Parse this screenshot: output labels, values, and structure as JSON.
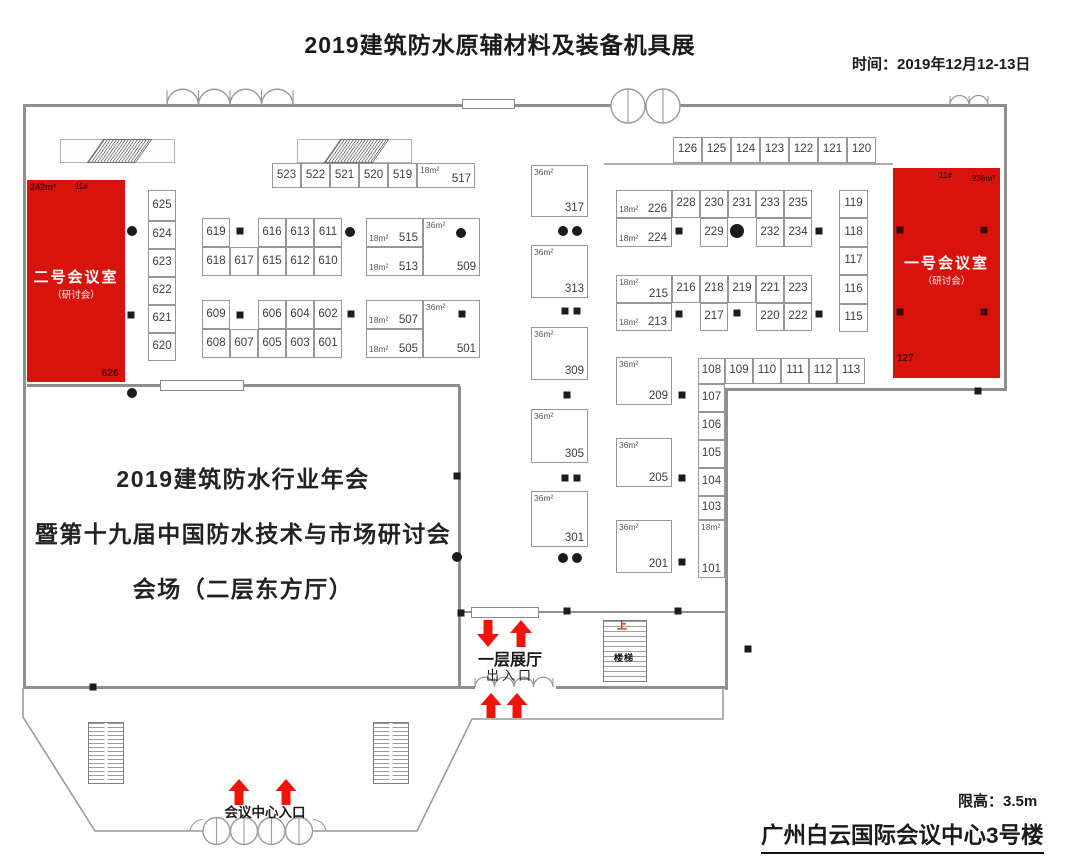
{
  "header": {
    "title": "2019建筑防水原辅材料及装备机具展",
    "time_label": "时间：2019年12月12-13日"
  },
  "footer": {
    "height_limit": "限高：3.5m",
    "building": "广州白云国际会议中心3号楼"
  },
  "hall_text": {
    "line1": "2019建筑防水行业年会",
    "line2": "暨第十九届中国防水技术与市场研讨会",
    "line3": "会场（二层东方厅）"
  },
  "rooms": {
    "room2": {
      "area": "242m²",
      "lot": "11#",
      "name": "二号会议室",
      "sub": "（研讨会）",
      "booth": "626"
    },
    "room1": {
      "lot": "11#",
      "area": "236m²",
      "name": "一号会议室",
      "sub": "（研讨会）",
      "booth": "127"
    }
  },
  "labels": {
    "stairs": "楼梯",
    "up": "上",
    "hall_1f": "一层展厅",
    "exit": "出入口",
    "center_entrance": "会议中心入口"
  },
  "colors": {
    "room_red": "#d8130d",
    "arrow_red": "#ee1409",
    "wall_gray": "#8f8f8f",
    "booth_border": "#979797"
  },
  "booths": [
    {
      "x": 272,
      "y": 163,
      "w": 29,
      "h": 25,
      "n": "523"
    },
    {
      "x": 301,
      "y": 163,
      "w": 29,
      "h": 25,
      "n": "522"
    },
    {
      "x": 330,
      "y": 163,
      "w": 29,
      "h": 25,
      "n": "521"
    },
    {
      "x": 359,
      "y": 163,
      "w": 29,
      "h": 25,
      "n": "520"
    },
    {
      "x": 388,
      "y": 163,
      "w": 29,
      "h": 25,
      "n": "519"
    },
    {
      "x": 417,
      "y": 163,
      "w": 58,
      "h": 25,
      "n": "517",
      "a": "18m²",
      "s": "corner"
    },
    {
      "x": 148,
      "y": 190,
      "w": 28,
      "h": 31,
      "n": "625"
    },
    {
      "x": 148,
      "y": 221,
      "w": 28,
      "h": 28,
      "n": "624"
    },
    {
      "x": 148,
      "y": 249,
      "w": 28,
      "h": 28,
      "n": "623"
    },
    {
      "x": 148,
      "y": 277,
      "w": 28,
      "h": 28,
      "n": "622"
    },
    {
      "x": 148,
      "y": 305,
      "w": 28,
      "h": 28,
      "n": "621"
    },
    {
      "x": 148,
      "y": 333,
      "w": 28,
      "h": 28,
      "n": "620"
    },
    {
      "x": 202,
      "y": 218,
      "w": 28,
      "h": 29,
      "n": "619"
    },
    {
      "x": 258,
      "y": 218,
      "w": 28,
      "h": 29,
      "n": "616"
    },
    {
      "x": 286,
      "y": 218,
      "w": 28,
      "h": 29,
      "n": "613"
    },
    {
      "x": 314,
      "y": 218,
      "w": 28,
      "h": 29,
      "n": "611"
    },
    {
      "x": 202,
      "y": 247,
      "w": 28,
      "h": 29,
      "n": "618"
    },
    {
      "x": 230,
      "y": 247,
      "w": 28,
      "h": 29,
      "n": "617"
    },
    {
      "x": 258,
      "y": 247,
      "w": 28,
      "h": 29,
      "n": "615"
    },
    {
      "x": 286,
      "y": 247,
      "w": 28,
      "h": 29,
      "n": "612"
    },
    {
      "x": 314,
      "y": 247,
      "w": 28,
      "h": 29,
      "n": "610"
    },
    {
      "x": 202,
      "y": 300,
      "w": 28,
      "h": 29,
      "n": "609"
    },
    {
      "x": 258,
      "y": 300,
      "w": 28,
      "h": 29,
      "n": "606"
    },
    {
      "x": 286,
      "y": 300,
      "w": 28,
      "h": 29,
      "n": "604"
    },
    {
      "x": 314,
      "y": 300,
      "w": 28,
      "h": 29,
      "n": "602"
    },
    {
      "x": 202,
      "y": 329,
      "w": 28,
      "h": 29,
      "n": "608"
    },
    {
      "x": 230,
      "y": 329,
      "w": 28,
      "h": 29,
      "n": "607"
    },
    {
      "x": 258,
      "y": 329,
      "w": 28,
      "h": 29,
      "n": "605"
    },
    {
      "x": 286,
      "y": 329,
      "w": 28,
      "h": 29,
      "n": "603"
    },
    {
      "x": 314,
      "y": 329,
      "w": 28,
      "h": 29,
      "n": "601"
    },
    {
      "x": 366,
      "y": 218,
      "w": 57,
      "h": 29,
      "n": "515",
      "a": "18m²",
      "s": "inline"
    },
    {
      "x": 366,
      "y": 247,
      "w": 57,
      "h": 29,
      "n": "513",
      "a": "18m²",
      "s": "inline"
    },
    {
      "x": 423,
      "y": 218,
      "w": 57,
      "h": 58,
      "n": "509",
      "a": "36m²",
      "s": "corner"
    },
    {
      "x": 366,
      "y": 300,
      "w": 57,
      "h": 29,
      "n": "507",
      "a": "18m²",
      "s": "inline"
    },
    {
      "x": 366,
      "y": 329,
      "w": 57,
      "h": 29,
      "n": "505",
      "a": "18m²",
      "s": "inline"
    },
    {
      "x": 423,
      "y": 300,
      "w": 57,
      "h": 58,
      "n": "501",
      "a": "36m²",
      "s": "corner"
    },
    {
      "x": 531,
      "y": 165,
      "w": 57,
      "h": 52,
      "n": "317",
      "a": "36m²",
      "s": "corner"
    },
    {
      "x": 531,
      "y": 245,
      "w": 57,
      "h": 53,
      "n": "313",
      "a": "36m²",
      "s": "corner"
    },
    {
      "x": 531,
      "y": 327,
      "w": 57,
      "h": 53,
      "n": "309",
      "a": "36m²",
      "s": "corner"
    },
    {
      "x": 531,
      "y": 409,
      "w": 57,
      "h": 54,
      "n": "305",
      "a": "36m²",
      "s": "corner"
    },
    {
      "x": 531,
      "y": 491,
      "w": 57,
      "h": 56,
      "n": "301",
      "a": "36m²",
      "s": "corner"
    },
    {
      "x": 616,
      "y": 190,
      "w": 56,
      "h": 28,
      "n": "226",
      "a": "18m²",
      "s": "inline"
    },
    {
      "x": 672,
      "y": 190,
      "w": 28,
      "h": 28,
      "n": "228"
    },
    {
      "x": 700,
      "y": 190,
      "w": 28,
      "h": 28,
      "n": "230"
    },
    {
      "x": 728,
      "y": 190,
      "w": 28,
      "h": 28,
      "n": "231"
    },
    {
      "x": 756,
      "y": 190,
      "w": 28,
      "h": 28,
      "n": "233"
    },
    {
      "x": 784,
      "y": 190,
      "w": 28,
      "h": 28,
      "n": "235"
    },
    {
      "x": 616,
      "y": 218,
      "w": 56,
      "h": 29,
      "n": "224",
      "a": "18m²",
      "s": "inline"
    },
    {
      "x": 700,
      "y": 218,
      "w": 28,
      "h": 29,
      "n": "229"
    },
    {
      "x": 756,
      "y": 218,
      "w": 28,
      "h": 29,
      "n": "232"
    },
    {
      "x": 784,
      "y": 218,
      "w": 28,
      "h": 29,
      "n": "234"
    },
    {
      "x": 616,
      "y": 275,
      "w": 56,
      "h": 28,
      "n": "215",
      "a": "18m²",
      "s": "corner"
    },
    {
      "x": 672,
      "y": 275,
      "w": 28,
      "h": 28,
      "n": "216"
    },
    {
      "x": 700,
      "y": 275,
      "w": 28,
      "h": 28,
      "n": "218"
    },
    {
      "x": 728,
      "y": 275,
      "w": 28,
      "h": 28,
      "n": "219"
    },
    {
      "x": 756,
      "y": 275,
      "w": 28,
      "h": 28,
      "n": "221"
    },
    {
      "x": 784,
      "y": 275,
      "w": 28,
      "h": 28,
      "n": "223"
    },
    {
      "x": 616,
      "y": 303,
      "w": 56,
      "h": 28,
      "n": "213",
      "a": "18m²",
      "s": "inline"
    },
    {
      "x": 700,
      "y": 303,
      "w": 28,
      "h": 28,
      "n": "217"
    },
    {
      "x": 756,
      "y": 303,
      "w": 28,
      "h": 28,
      "n": "220"
    },
    {
      "x": 784,
      "y": 303,
      "w": 28,
      "h": 28,
      "n": "222"
    },
    {
      "x": 673,
      "y": 137,
      "w": 29,
      "h": 26,
      "n": "126"
    },
    {
      "x": 702,
      "y": 137,
      "w": 29,
      "h": 26,
      "n": "125"
    },
    {
      "x": 731,
      "y": 137,
      "w": 29,
      "h": 26,
      "n": "124"
    },
    {
      "x": 760,
      "y": 137,
      "w": 29,
      "h": 26,
      "n": "123"
    },
    {
      "x": 789,
      "y": 137,
      "w": 29,
      "h": 26,
      "n": "122"
    },
    {
      "x": 818,
      "y": 137,
      "w": 29,
      "h": 26,
      "n": "121"
    },
    {
      "x": 847,
      "y": 137,
      "w": 29,
      "h": 26,
      "n": "120"
    },
    {
      "x": 839,
      "y": 190,
      "w": 29,
      "h": 28,
      "n": "119"
    },
    {
      "x": 839,
      "y": 218,
      "w": 29,
      "h": 29,
      "n": "118"
    },
    {
      "x": 839,
      "y": 247,
      "w": 29,
      "h": 28,
      "n": "117"
    },
    {
      "x": 839,
      "y": 275,
      "w": 29,
      "h": 29,
      "n": "116"
    },
    {
      "x": 839,
      "y": 304,
      "w": 29,
      "h": 28,
      "n": "115"
    },
    {
      "x": 616,
      "y": 357,
      "w": 56,
      "h": 48,
      "n": "209",
      "a": "36m²",
      "s": "corner"
    },
    {
      "x": 616,
      "y": 438,
      "w": 56,
      "h": 49,
      "n": "205",
      "a": "36m²",
      "s": "corner"
    },
    {
      "x": 616,
      "y": 520,
      "w": 56,
      "h": 53,
      "n": "201",
      "a": "36m²",
      "s": "corner"
    },
    {
      "x": 698,
      "y": 358,
      "w": 27,
      "h": 26,
      "n": "108"
    },
    {
      "x": 725,
      "y": 358,
      "w": 28,
      "h": 26,
      "n": "109"
    },
    {
      "x": 753,
      "y": 358,
      "w": 28,
      "h": 26,
      "n": "110"
    },
    {
      "x": 781,
      "y": 358,
      "w": 28,
      "h": 26,
      "n": "111"
    },
    {
      "x": 809,
      "y": 358,
      "w": 28,
      "h": 26,
      "n": "112"
    },
    {
      "x": 837,
      "y": 358,
      "w": 28,
      "h": 26,
      "n": "113"
    },
    {
      "x": 698,
      "y": 384,
      "w": 27,
      "h": 28,
      "n": "107"
    },
    {
      "x": 698,
      "y": 412,
      "w": 27,
      "h": 28,
      "n": "106"
    },
    {
      "x": 698,
      "y": 440,
      "w": 27,
      "h": 28,
      "n": "105"
    },
    {
      "x": 698,
      "y": 468,
      "w": 27,
      "h": 28,
      "n": "104"
    },
    {
      "x": 698,
      "y": 496,
      "w": 27,
      "h": 24,
      "n": "103"
    },
    {
      "x": 698,
      "y": 520,
      "w": 27,
      "h": 58,
      "n": "101",
      "a": "18m²",
      "s": "corner"
    }
  ],
  "pillars": [
    {
      "x": 132,
      "y": 231,
      "t": "c"
    },
    {
      "x": 350,
      "y": 232,
      "t": "c"
    },
    {
      "x": 461,
      "y": 233,
      "t": "c"
    },
    {
      "x": 563,
      "y": 231,
      "t": "c"
    },
    {
      "x": 577,
      "y": 231,
      "t": "c"
    },
    {
      "x": 737,
      "y": 231,
      "t": "cb"
    },
    {
      "x": 563,
      "y": 558,
      "t": "c"
    },
    {
      "x": 577,
      "y": 558,
      "t": "c"
    },
    {
      "x": 132,
      "y": 393,
      "t": "c"
    },
    {
      "x": 457,
      "y": 557,
      "t": "c"
    },
    {
      "x": 131,
      "y": 315,
      "t": "s"
    },
    {
      "x": 240,
      "y": 231,
      "t": "s"
    },
    {
      "x": 351,
      "y": 314,
      "t": "s"
    },
    {
      "x": 462,
      "y": 314,
      "t": "s"
    },
    {
      "x": 565,
      "y": 311,
      "t": "s"
    },
    {
      "x": 577,
      "y": 311,
      "t": "s"
    },
    {
      "x": 567,
      "y": 395,
      "t": "s"
    },
    {
      "x": 565,
      "y": 478,
      "t": "s"
    },
    {
      "x": 577,
      "y": 478,
      "t": "s"
    },
    {
      "x": 679,
      "y": 231,
      "t": "s"
    },
    {
      "x": 819,
      "y": 231,
      "t": "s"
    },
    {
      "x": 679,
      "y": 314,
      "t": "s"
    },
    {
      "x": 737,
      "y": 313,
      "t": "s"
    },
    {
      "x": 819,
      "y": 314,
      "t": "s"
    },
    {
      "x": 682,
      "y": 395,
      "t": "s"
    },
    {
      "x": 682,
      "y": 478,
      "t": "s"
    },
    {
      "x": 682,
      "y": 562,
      "t": "s"
    },
    {
      "x": 457,
      "y": 476,
      "t": "s"
    },
    {
      "x": 461,
      "y": 613,
      "t": "s"
    },
    {
      "x": 567,
      "y": 611,
      "t": "s"
    },
    {
      "x": 678,
      "y": 611,
      "t": "s"
    },
    {
      "x": 748,
      "y": 649,
      "t": "s"
    },
    {
      "x": 93,
      "y": 687,
      "t": "s"
    },
    {
      "x": 978,
      "y": 391,
      "t": "s"
    },
    {
      "x": 240,
      "y": 315,
      "t": "s"
    },
    {
      "x": 900,
      "y": 230,
      "t": "sd"
    },
    {
      "x": 984,
      "y": 230,
      "t": "sd"
    },
    {
      "x": 900,
      "y": 312,
      "t": "sd"
    },
    {
      "x": 984,
      "y": 312,
      "t": "sd"
    }
  ]
}
